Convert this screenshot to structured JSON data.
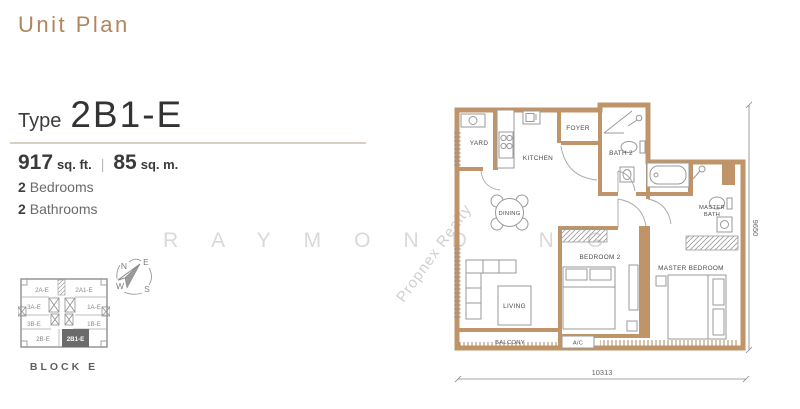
{
  "header": {
    "title": "Unit Plan"
  },
  "unit": {
    "type_label": "Type",
    "type_name": "2B1-E",
    "area_sqft_value": "917",
    "area_sqft_unit": "sq. ft.",
    "area_divider": "|",
    "area_sqm_value": "85",
    "area_sqm_unit": "sq. m.",
    "bedrooms_count": "2",
    "bedrooms_label": "Bedrooms",
    "bathrooms_count": "2",
    "bathrooms_label": "Bathrooms"
  },
  "key_plan": {
    "block_label": "BLOCK E",
    "units": {
      "top_left": "2A-E",
      "top_right": "2A1-E",
      "mid_left": "3A-E",
      "mid_right": "1A-E",
      "low_left": "3B-E",
      "low_right": "1B-E",
      "bottom_left": "2B-E",
      "highlighted": "2B1-E"
    }
  },
  "compass": {
    "north": "N",
    "east": "E",
    "west": "W",
    "south": "S"
  },
  "floor_plan": {
    "rooms": {
      "yard": "YARD",
      "kitchen": "KITCHEN",
      "foyer": "FOYER",
      "bath2": "BATH 2",
      "dining": "DINING",
      "master_bath_line1": "MASTER",
      "master_bath_line2": "BATH",
      "bedroom2": "BEDROOM 2",
      "master_bedroom": "MASTER BEDROOM",
      "living": "LIVING",
      "balcony": "BALCONY",
      "ac": "A/C"
    },
    "dimensions": {
      "bottom": "10313",
      "right": "9650"
    }
  },
  "watermark": {
    "name": "RAYMOND NG",
    "agency": "Propnex Realty"
  },
  "colors": {
    "accent": "#b1855c",
    "wall": "#bf9468",
    "key_highlight": "#6b6b6b",
    "watermark": "#d9d9d9"
  }
}
